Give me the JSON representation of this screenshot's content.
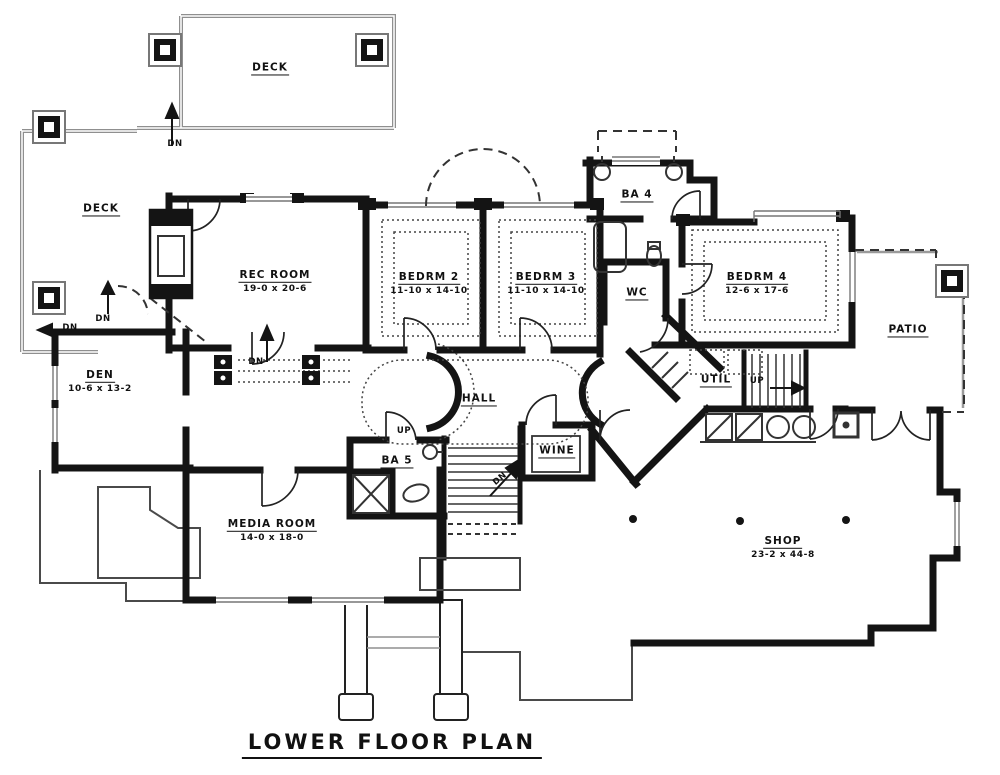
{
  "title": "LOWER FLOOR PLAN",
  "rooms": {
    "deck_top": {
      "name": "DECK"
    },
    "deck_left": {
      "name": "DECK"
    },
    "rec_room": {
      "name": "REC ROOM",
      "dims": "19-0 x 20-6"
    },
    "bedrm2": {
      "name": "BEDRM 2",
      "dims": "11-10 x 14-10"
    },
    "bedrm3": {
      "name": "BEDRM 3",
      "dims": "11-10 x 14-10"
    },
    "ba4": {
      "name": "BA 4"
    },
    "wc": {
      "name": "WC"
    },
    "bedrm4": {
      "name": "BEDRM 4",
      "dims": "12-6 x 17-6"
    },
    "patio": {
      "name": "PATIO"
    },
    "den": {
      "name": "DEN",
      "dims": "10-6 x 13-2"
    },
    "media_room": {
      "name": "MEDIA ROOM",
      "dims": "14-0 x 18-0"
    },
    "hall": {
      "name": "HALL"
    },
    "ba5": {
      "name": "BA 5"
    },
    "wine": {
      "name": "WINE"
    },
    "util": {
      "name": "UTIL"
    },
    "shop": {
      "name": "SHOP",
      "dims": "23-2 x 44-8"
    }
  },
  "stairs": {
    "up_label": "UP",
    "dn_label": "DN"
  },
  "colors": {
    "wall": "#141414",
    "deck_rail": "#8f8f8f",
    "foundation": "#4a4a4a",
    "background": "#ffffff"
  }
}
